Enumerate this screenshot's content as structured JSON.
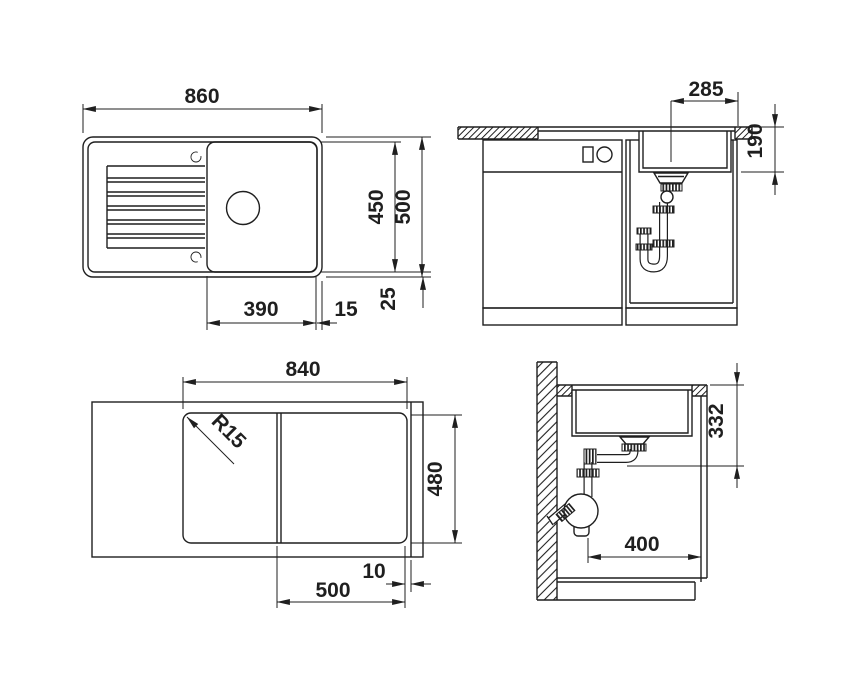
{
  "colors": {
    "line": "#1f1f1f",
    "background": "#ffffff"
  },
  "views": {
    "plan_top": {
      "labels": {
        "overall_width": "860",
        "basin_depth": "450",
        "overall_depth": "500",
        "bowl_width": "390",
        "bowl_edge_gap": "15",
        "rim_inset": "25"
      }
    },
    "front_section": {
      "labels": {
        "drain_center_offset": "285",
        "bowl_depth": "190"
      }
    },
    "plan_bottom": {
      "labels": {
        "cutout_width": "840",
        "corner_radius": "R15",
        "cutout_depth": "480",
        "bowl_underside_width": "500",
        "underside_lip": "10"
      }
    },
    "side_section": {
      "labels": {
        "drain_outlet_height": "332",
        "base_clearance": "400"
      }
    }
  }
}
